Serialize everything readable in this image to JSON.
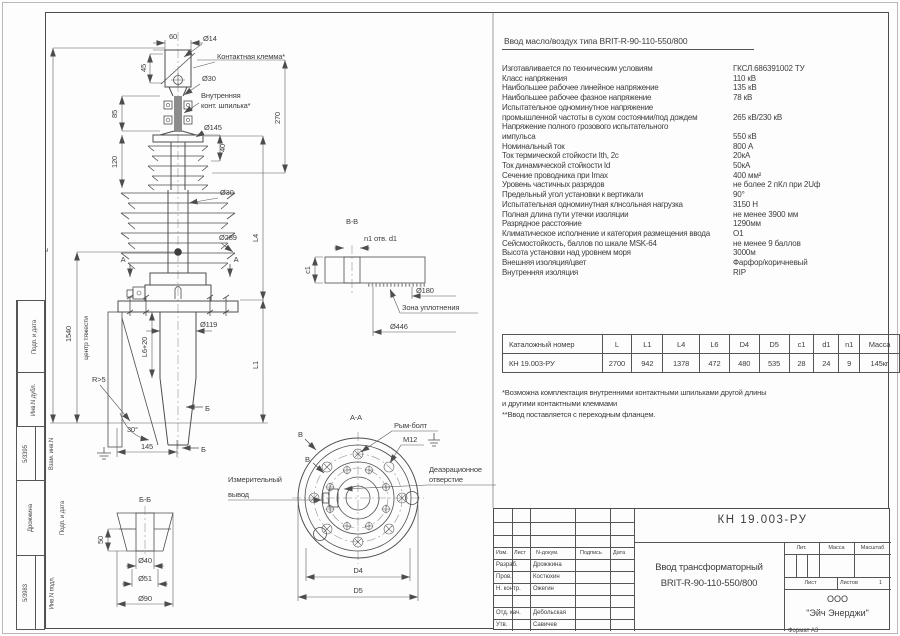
{
  "sheet": {
    "format": "Формат А3"
  },
  "margin_stamp": {
    "fields": [
      {
        "label": "Подп. и дата",
        "value": ""
      },
      {
        "label": "Инв.N дубл.",
        "value": ""
      },
      {
        "label": "Взам. инв.N",
        "value": "5/3395"
      },
      {
        "label": "Подп. и дата",
        "value": "Дрожжина"
      },
      {
        "label": "Инв.N подл.",
        "value": "5/3983"
      }
    ]
  },
  "drawing": {
    "labels": {
      "d60": "60",
      "d14": "Ø14",
      "klemma": "Контактная клемма*",
      "d45": "45",
      "d30top": "Ø30",
      "shp1": "Внутренняя",
      "shp2": "конт. шпилька*",
      "d85": "85",
      "d145": "Ø145",
      "d120": "120",
      "d40v": "40",
      "d270": "270",
      "d30mid": "Ø30",
      "d289": "Ø289",
      "L": "L",
      "L4": "L4",
      "n1540": "1540",
      "cog": "центр тяжести",
      "L6": "L6+20",
      "d119": "Ø119",
      "r5": "R>5",
      "L1": "L1",
      "bmark": "Б",
      "deg30": "30°",
      "d145b": "145",
      "bb": "Б-Б",
      "d50": "50",
      "d40": "Ø40",
      "d51": "Ø51",
      "d90": "Ø90",
      "vv": "В-В",
      "n1otv": "n1 отв. d1",
      "c1": "c1",
      "d180": "Ø180",
      "seal": "Зона уплотнения",
      "d446": "Ø446",
      "aa": "А-А",
      "rym": "Рым-болт",
      "m12": "М12",
      "dea1": "Деаэрационное",
      "dea2": "отверстие",
      "mea1": "Измерительный",
      "mea2": "вывод",
      "D4": "D4",
      "D5": "D5",
      "amark": "А",
      "vmark": "В"
    }
  },
  "specs": {
    "title": "Ввод масло/воздух типа BRIT-R-90-110-550/800",
    "rows": [
      {
        "label": "Изготавливается по техническим условиям",
        "value": "ГКСЛ.686391002 ТУ"
      },
      {
        "label": "Класс напряжения",
        "value": "110 кВ"
      },
      {
        "label": "Наибольшее рабочее линейное напряжение",
        "value": "135 кВ"
      },
      {
        "label": "Наибольшее рабочее фазное напряжение",
        "value": "78 кВ"
      },
      {
        "label": "Испытательное одноминутное напряжение\nпромышленной частоты в сухом состоянии/под дождем",
        "value": "265 кВ/230 кВ"
      },
      {
        "label": "Напряжение полного грозового испытательного\nимпульса",
        "value": "550 кВ"
      },
      {
        "label": "Номинальный ток",
        "value": "800 А"
      },
      {
        "label": "Ток термической стойкости Ith, 2с",
        "value": "20кА"
      },
      {
        "label": "Ток динамической стойкости Id",
        "value": "50кА"
      },
      {
        "label": "Сечение проводника при Imax",
        "value": "400 мм²"
      },
      {
        "label": "Уровень частичных разрядов",
        "value": "не более 2 пКл при 2Uф"
      },
      {
        "label": "Предельный угол установки к вертикали",
        "value": "90°"
      },
      {
        "label": "Испытательная одноминутная клнсольная нагрузка",
        "value": "3150 Н"
      },
      {
        "label": "Полная длина пути утечки изоляции",
        "value": "не менее 3900 мм"
      },
      {
        "label": "Разрядное расстояние",
        "value": "1290мм"
      },
      {
        "label": "Климатическое исполнение и категория размещения ввода",
        "value": "О1"
      },
      {
        "label": "Сейсмостойкость, баллов по шкале MSK-64",
        "value": "не менее 9 баллов"
      },
      {
        "label": "Высота установки над уровнем моря",
        "value": "3000м"
      },
      {
        "label": "Внешняя изоляция/цвет",
        "value": "Фарфор/коричневый"
      },
      {
        "label": "Внутренняя изоляция",
        "value": "RIP"
      }
    ]
  },
  "dim_table": {
    "headers": [
      "Каталожный номер",
      "L",
      "L1",
      "L4",
      "L6",
      "D4",
      "D5",
      "c1",
      "d1",
      "n1",
      "Масса"
    ],
    "row": [
      "КН 19.003-РУ",
      "2700",
      "942",
      "1378",
      "472",
      "480",
      "535",
      "28",
      "24",
      "9",
      "145кг"
    ]
  },
  "notes": [
    "*Возможна комплектация внутренними контактными шпильками другой длины",
    "и другими контактными клеммами",
    "**Ввод  поставляется с переходным фланцем."
  ],
  "title_block": {
    "doc_number": "КН 19.003-РУ",
    "product_line1": "Ввод трансформаторный",
    "product_line2": "BRIT-R-90-110-550/800",
    "cols": [
      "Изм.",
      "Лист",
      "N-докум.",
      "Подпись",
      "Дата"
    ],
    "rows": [
      [
        "Разраб.",
        "Дрожжина"
      ],
      [
        "Пров.",
        "Костюхин"
      ],
      [
        "Н. контр.",
        "Ожегин"
      ],
      [
        "",
        ""
      ],
      [
        "Отд. кач.",
        "Дебольская"
      ],
      [
        "Утв.",
        "Савичев"
      ]
    ],
    "lit": "Лит.",
    "mass": "Масса",
    "scale": "Масштаб",
    "sheet": "Лист",
    "sheets": "Листов",
    "sheets_value": "1",
    "company1": "ООО",
    "company2": "\"Эйч Энерджи\""
  }
}
